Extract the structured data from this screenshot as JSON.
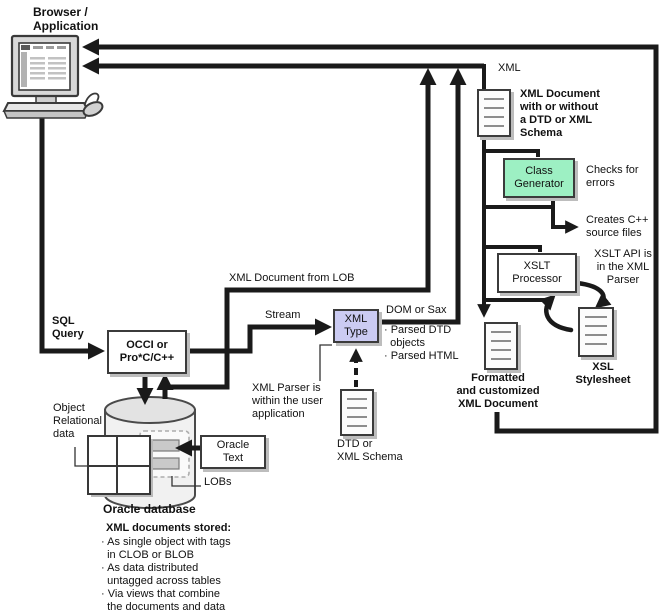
{
  "diagram": {
    "browser": {
      "label": "Browser /\nApplication"
    },
    "flows": {
      "xml": "XML",
      "sql_query": "SQL\nQuery",
      "stream": "Stream",
      "dom_or_sax": "DOM or Sax",
      "xml_doc_from_lob": "XML Document from LOB",
      "parsed_outputs": "· Parsed DTD\n  objects\n· Parsed HTML"
    },
    "boxes": {
      "occi": "OCCI or\nPro*C/C++",
      "xml_type": "XML\nType",
      "class_generator": "Class\nGenerator",
      "xslt_processor": "XSLT\nProcessor",
      "oracle_text": "Oracle\nText"
    },
    "notes": {
      "xml_document": "XML Document\nwith or without\na DTD or XML\nSchema",
      "checks_for_errors": "Checks for\nerrors",
      "creates_cpp": "Creates C++\nsource files",
      "xslt_api": "XSLT API is\nin the XML\nParser",
      "xml_parser": "XML Parser is\nwithin the user\napplication",
      "dtd_or_schema": "DTD or\nXML Schema",
      "formatted_doc": "Formatted\nand customized\nXML Document",
      "xsl_stylesheet": "XSL\nStylesheet"
    },
    "database": {
      "object_relational": "Object\nRelational\ndata",
      "lobs": "LOBs",
      "title": "Oracle database"
    },
    "storage": {
      "title": "XML documents stored:",
      "items": [
        "· As single object with tags\n  in CLOB or BLOB",
        "· As data distributed\n  untagged across tables",
        "· Via views that combine\n  the documents and data"
      ]
    },
    "colors": {
      "class_generator_fill": "#9DF0C3",
      "xml_type_fill": "#CBCBF2"
    }
  }
}
